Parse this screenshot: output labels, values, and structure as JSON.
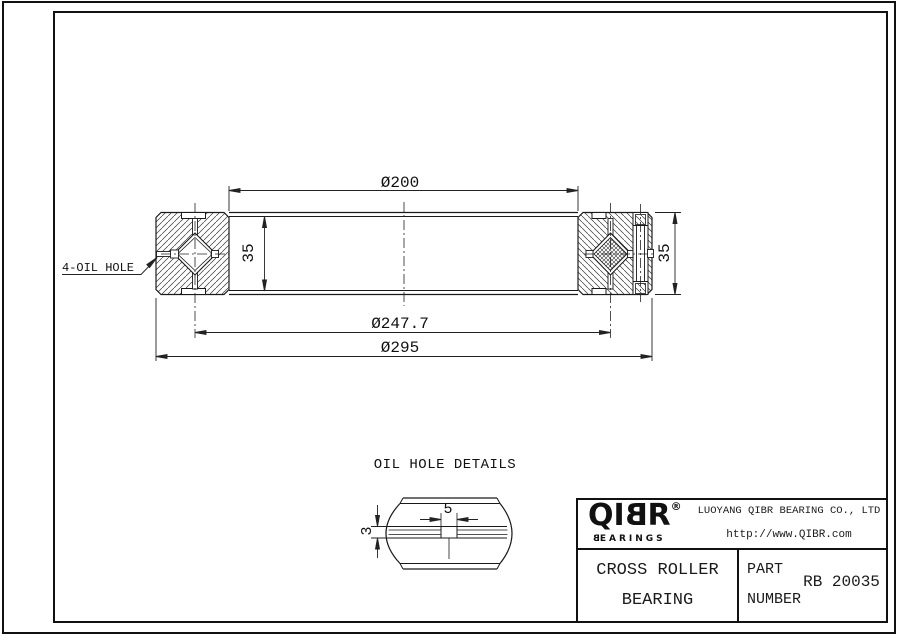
{
  "page": {
    "background": "#ffffff",
    "line_color": "#1a1a1a"
  },
  "drawing": {
    "dim_bore": "Ø200",
    "dim_pitch": "Ø247.7",
    "dim_outer": "Ø295",
    "dim_width_left": "35",
    "dim_width_right": "35",
    "oil_hole_callout": "4-OIL HOLE"
  },
  "oil_hole_detail": {
    "title": "OIL HOLE DETAILS",
    "dim_width": "5",
    "dim_depth": "3"
  },
  "title_block": {
    "logo_left": "QI",
    "logo_b": "B",
    "logo_r": "R",
    "registered_mark": "®",
    "logo_sub_b": "B",
    "logo_sub_rest": "EARINGS",
    "company_name": "LUOYANG QIBR BEARING CO., LTD",
    "website": "http://www.QIBR.com",
    "product_name_line1": "CROSS ROLLER",
    "product_name_line2": "BEARING",
    "part_label_line1": "PART",
    "part_label_line2": "NUMBER",
    "part_number": "RB 20035"
  }
}
